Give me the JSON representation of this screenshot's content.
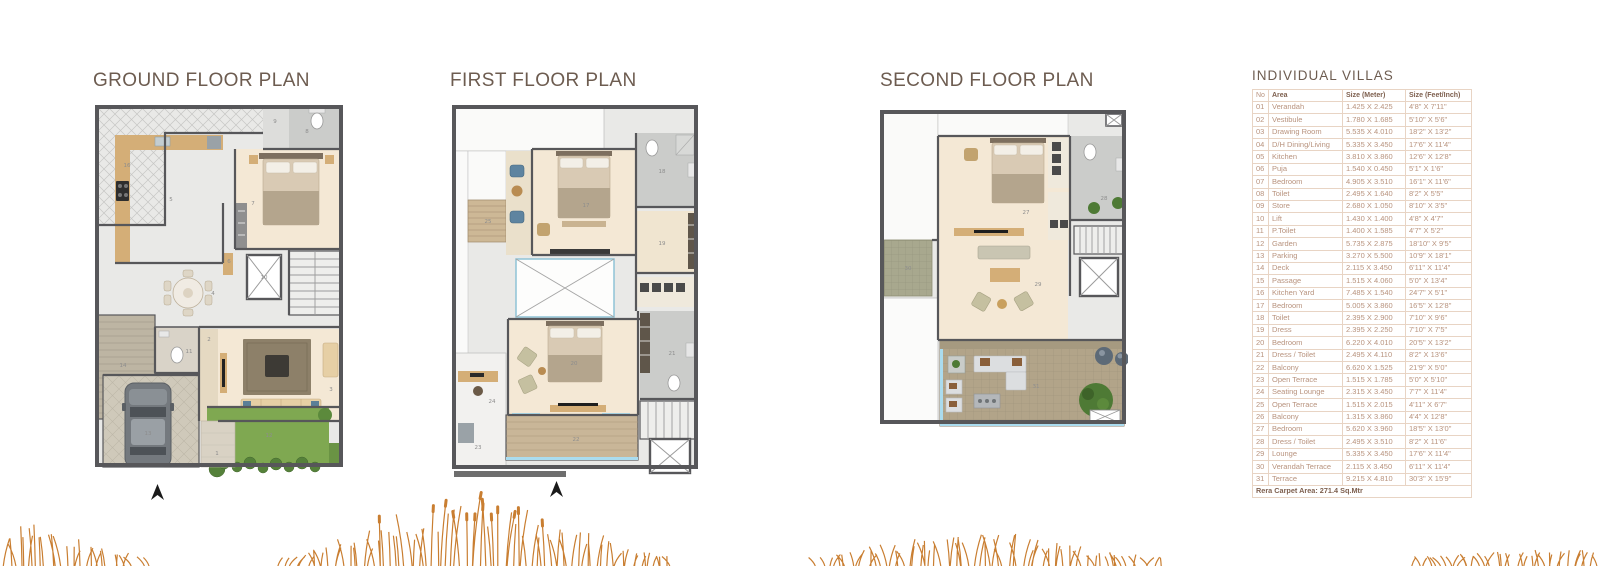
{
  "plans": [
    {
      "id": "ground",
      "title": "GROUND FLOOR PLAN",
      "labels": [
        {
          "n": "16",
          "x": 34,
          "y": 64
        },
        {
          "n": "9",
          "x": 182,
          "y": 20
        },
        {
          "n": "8",
          "x": 214,
          "y": 30
        },
        {
          "n": "5",
          "x": 78,
          "y": 98
        },
        {
          "n": "7",
          "x": 160,
          "y": 102
        },
        {
          "n": "6",
          "x": 136,
          "y": 160
        },
        {
          "n": "10",
          "x": 171,
          "y": 176
        },
        {
          "n": "4",
          "x": 120,
          "y": 192
        },
        {
          "n": "14",
          "x": 30,
          "y": 264
        },
        {
          "n": "11",
          "x": 96,
          "y": 250
        },
        {
          "n": "2",
          "x": 116,
          "y": 238
        },
        {
          "n": "3",
          "x": 238,
          "y": 288
        },
        {
          "n": "13",
          "x": 55,
          "y": 332
        },
        {
          "n": "12",
          "x": 176,
          "y": 334
        },
        {
          "n": "1",
          "x": 124,
          "y": 352
        }
      ]
    },
    {
      "id": "first",
      "title": "FIRST FLOOR PLAN",
      "labels": [
        {
          "n": "25",
          "x": 38,
          "y": 120
        },
        {
          "n": "17",
          "x": 136,
          "y": 104
        },
        {
          "n": "18",
          "x": 212,
          "y": 70
        },
        {
          "n": "19",
          "x": 212,
          "y": 142
        },
        {
          "n": "24",
          "x": 42,
          "y": 300
        },
        {
          "n": "20",
          "x": 124,
          "y": 262
        },
        {
          "n": "21",
          "x": 222,
          "y": 252
        },
        {
          "n": "22",
          "x": 126,
          "y": 338
        },
        {
          "n": "23",
          "x": 28,
          "y": 346
        }
      ]
    },
    {
      "id": "second",
      "title": "SECOND FLOOR PLAN",
      "labels": [
        {
          "n": "27",
          "x": 148,
          "y": 106
        },
        {
          "n": "28",
          "x": 226,
          "y": 92
        },
        {
          "n": "29",
          "x": 160,
          "y": 178
        },
        {
          "n": "30",
          "x": 30,
          "y": 162
        },
        {
          "n": "31",
          "x": 158,
          "y": 280
        }
      ]
    }
  ],
  "table": {
    "title": "INDIVIDUAL VILLAS",
    "headers": [
      "No",
      "Area",
      "Size (Meter)",
      "Size (Feet/Inch)"
    ],
    "rows": [
      [
        "01",
        "Verandah",
        "1.425 X 2.425",
        "4'8\" X 7'11\""
      ],
      [
        "02",
        "Vestibule",
        "1.780 X 1.685",
        "5'10\" X 5'6\""
      ],
      [
        "03",
        "Drawing Room",
        "5.535 X 4.010",
        "18'2\" X 13'2\""
      ],
      [
        "04",
        "D/H Dining/Living",
        "5.335 X 3.450",
        "17'6\" X 11'4\""
      ],
      [
        "05",
        "Kitchen",
        "3.810 X 3.860",
        "12'6\" X 12'8\""
      ],
      [
        "06",
        "Puja",
        "1.540 X 0.450",
        "5'1\" X 1'6\""
      ],
      [
        "07",
        "Bedroom",
        "4.905 X 3.510",
        "16'1\" X 11'6\""
      ],
      [
        "08",
        "Toilet",
        "2.495 X 1.640",
        "8'2\" X 5'5\""
      ],
      [
        "09",
        "Store",
        "2.680 X 1.050",
        "8'10\" X 3'5\""
      ],
      [
        "10",
        "Lift",
        "1.430 X 1.400",
        "4'8\" X 4'7\""
      ],
      [
        "11",
        "P.Toilet",
        "1.400 X 1.585",
        "4'7\" X 5'2\""
      ],
      [
        "12",
        "Garden",
        "5.735 X 2.875",
        "18'10\" X 9'5\""
      ],
      [
        "13",
        "Parking",
        "3.270 X 5.500",
        "10'9\" X 18'1\""
      ],
      [
        "14",
        "Deck",
        "2.115 X 3.450",
        "6'11\" X 11'4\""
      ],
      [
        "15",
        "Passage",
        "1.515 X 4.060",
        "5'0\" X 13'4\""
      ],
      [
        "16",
        "Kitchen Yard",
        "7.485 X 1.540",
        "24'7\" X 5'1\""
      ],
      [
        "17",
        "Bedroom",
        "5.005 X 3.860",
        "16'5\" X 12'8\""
      ],
      [
        "18",
        "Toilet",
        "2.395 X 2.900",
        "7'10\" X 9'6\""
      ],
      [
        "19",
        "Dress",
        "2.395 X 2.250",
        "7'10\" X 7'5\""
      ],
      [
        "20",
        "Bedroom",
        "6.220 X 4.010",
        "20'5\" X 13'2\""
      ],
      [
        "21",
        "Dress / Toilet",
        "2.495 X 4.110",
        "8'2\" X 13'6\""
      ],
      [
        "22",
        "Balcony",
        "6.620 X 1.525",
        "21'9\" X 5'0\""
      ],
      [
        "23",
        "Open Terrace",
        "1.515 X 1.785",
        "5'0\" X 5'10\""
      ],
      [
        "24",
        "Seating Lounge",
        "2.315 X 3.450",
        "7'7\" X 11'4\""
      ],
      [
        "25",
        "Open Terrace",
        "1.515 X 2.015",
        "4'11\" X 6'7\""
      ],
      [
        "26",
        "Balcony",
        "1.315 X 3.860",
        "4'4\" X 12'8\""
      ],
      [
        "27",
        "Bedroom",
        "5.620 X 3.960",
        "18'5\" X 13'0\""
      ],
      [
        "28",
        "Dress / Toilet",
        "2.495 X 3.510",
        "8'2\" X 11'6\""
      ],
      [
        "29",
        "Lounge",
        "5.335 X 3.450",
        "17'6\" X 11'4\""
      ],
      [
        "30",
        "Verandah Terrace",
        "2.115 X 3.450",
        "6'11\" X 11'4\""
      ],
      [
        "31",
        "Terrace",
        "9.215 X 4.810",
        "30'3\" X 15'9\""
      ]
    ],
    "footer": "Rera Carpet Area: 271.4 Sq.Mtr"
  },
  "colors": {
    "title_text": "#6d5c50",
    "table_text": "#b8937e",
    "table_header_text": "#7d5f4e",
    "table_border": "#e8d4c4",
    "wall": "#57575a",
    "bedroom_floor": "#f4e8d5",
    "wood": "#d4ae77",
    "garden": "#7fa851",
    "terrace": "#b2a489",
    "grass": "#c97e31",
    "window": "#aadcef"
  },
  "icons": {
    "north_arrow": "north-arrow"
  }
}
